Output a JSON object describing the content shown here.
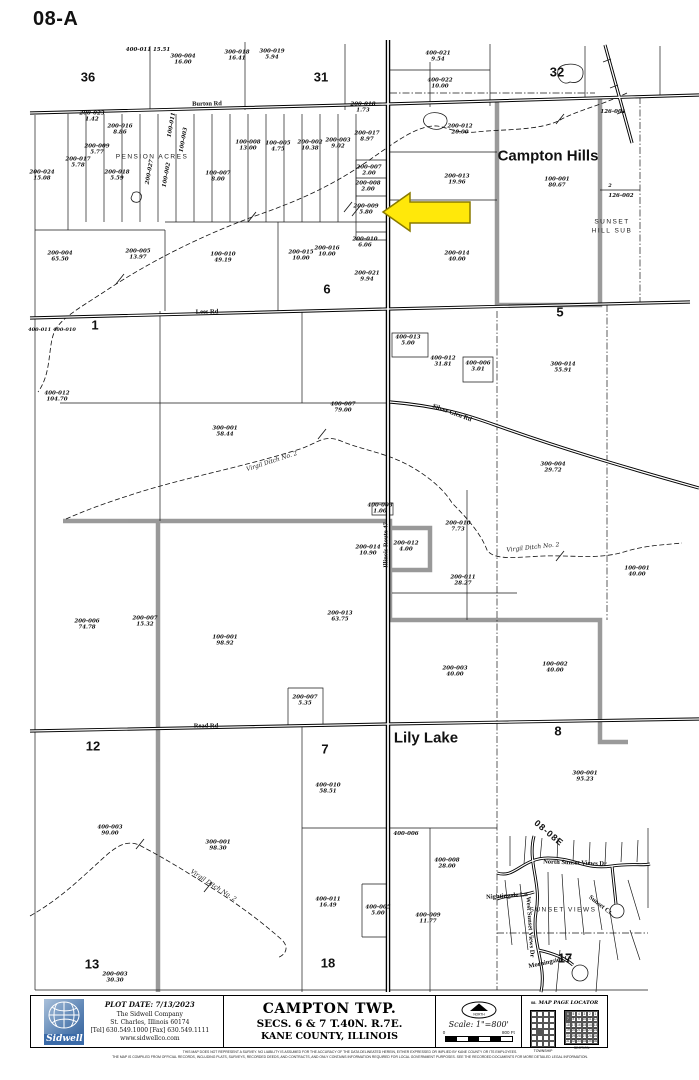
{
  "page": {
    "sheet_label": "08-A"
  },
  "map": {
    "arrow": {
      "target_parcel": "200-009",
      "color": "#ffe80a",
      "stroke": "#8a7a00"
    },
    "labels": [
      {
        "t": "Campton Hills",
        "x": 548,
        "y": 156,
        "cls": "muni",
        "name": "municipality-label-campton-hills"
      },
      {
        "t": "Lily Lake",
        "x": 426,
        "y": 738,
        "cls": "muni",
        "name": "municipality-label-lily-lake"
      },
      {
        "t": "36",
        "x": 88,
        "y": 77,
        "cls": "section",
        "name": "section-number-36"
      },
      {
        "t": "31",
        "x": 321,
        "y": 77,
        "cls": "section",
        "name": "section-number-31"
      },
      {
        "t": "32",
        "x": 557,
        "y": 72,
        "cls": "section",
        "name": "section-number-32"
      },
      {
        "t": "1",
        "x": 95,
        "y": 325,
        "cls": "section",
        "name": "section-number-1"
      },
      {
        "t": "6",
        "x": 327,
        "y": 289,
        "cls": "section",
        "name": "section-number-6"
      },
      {
        "t": "5",
        "x": 560,
        "y": 312,
        "cls": "section",
        "name": "section-number-5"
      },
      {
        "t": "12",
        "x": 93,
        "y": 746,
        "cls": "section",
        "name": "section-number-12"
      },
      {
        "t": "7",
        "x": 325,
        "y": 749,
        "cls": "section",
        "name": "section-number-7"
      },
      {
        "t": "8",
        "x": 558,
        "y": 731,
        "cls": "section",
        "name": "section-number-8"
      },
      {
        "t": "13",
        "x": 92,
        "y": 964,
        "cls": "section",
        "name": "section-number-13"
      },
      {
        "t": "18",
        "x": 328,
        "y": 963,
        "cls": "section",
        "name": "section-number-18"
      },
      {
        "t": "17",
        "x": 565,
        "y": 958,
        "cls": "section",
        "name": "section-number-17"
      },
      {
        "t": "Burton Rd",
        "x": 207,
        "y": 104,
        "r": -1,
        "cls": "road",
        "name": "road-label-burton-rd"
      },
      {
        "t": "Lees Rd",
        "x": 207,
        "y": 312,
        "r": -1,
        "cls": "road",
        "name": "road-label-lees-rd"
      },
      {
        "t": "Read Rd",
        "x": 206,
        "y": 726,
        "cls": "road",
        "name": "road-label-read-rd"
      },
      {
        "t": "Illinois Route 47",
        "x": 386,
        "y": 545,
        "r": -90,
        "cls": "road",
        "name": "road-label-illinois-route-47"
      },
      {
        "t": "Silver Glen Rd",
        "x": 452,
        "y": 413,
        "r": 20,
        "cls": "road",
        "name": "road-label-silver-glen-rd"
      },
      {
        "t": "North Sunset Views Dr",
        "x": 575,
        "y": 863,
        "r": 2,
        "cls": "road",
        "name": "road-label-north-sunset-views-dr"
      },
      {
        "t": "Nightingale Ln",
        "x": 507,
        "y": 896,
        "r": -4,
        "cls": "road",
        "name": "road-label-nightingale-ln"
      },
      {
        "t": "West Sunset Views Dr",
        "x": 530,
        "y": 927,
        "r": 86,
        "cls": "road",
        "name": "road-label-west-sunset-views-dr"
      },
      {
        "t": "Sunset Ct",
        "x": 600,
        "y": 905,
        "r": 38,
        "cls": "road",
        "name": "road-label-sunset-ct"
      },
      {
        "t": "Morningside Ct",
        "x": 550,
        "y": 962,
        "r": -12,
        "cls": "road",
        "name": "road-label-morningside-ct"
      },
      {
        "t": "PENSION ACRES",
        "x": 152,
        "y": 157,
        "cls": "subdiv",
        "name": "subdivision-label-pension-acres"
      },
      {
        "t": "SUNSET VIEWS",
        "x": 563,
        "y": 910,
        "cls": "subdiv",
        "name": "subdivision-label-sunset-views"
      },
      {
        "t": "SUNSET",
        "x": 612,
        "y": 222,
        "cls": "subdiv",
        "name": "subdivision-label-sunset-hill-sub"
      },
      {
        "t": "HILL SUB",
        "x": 612,
        "y": 231,
        "cls": "subdiv",
        "name": "subdivision-label-sunset-hill-sub-2"
      },
      {
        "t": "Virgil Ditch No. 2",
        "x": 272,
        "y": 462,
        "r": -18,
        "cls": "creek",
        "name": "creek-label-virgil-ditch-1"
      },
      {
        "t": "Virgil Ditch No. 2",
        "x": 533,
        "y": 548,
        "r": -6,
        "cls": "creek",
        "name": "creek-label-virgil-ditch-2"
      },
      {
        "t": "Virgil Ditch No. 2",
        "x": 213,
        "y": 886,
        "r": 33,
        "cls": "creek",
        "name": "creek-label-virgil-ditch-3"
      },
      {
        "t": "08-08E",
        "x": 549,
        "y": 833,
        "r": 40,
        "cls": "pageref",
        "name": "adjacent-page-label"
      },
      {
        "t": "400-011 400-010",
        "x": 52,
        "y": 330,
        "cls": "misc",
        "name": "parcel-pair-label"
      },
      {
        "t": "2",
        "x": 610,
        "y": 186,
        "cls": "misc",
        "name": "lot-number-2"
      }
    ],
    "parcels": [
      {
        "id": "400-011",
        "ac": "15.51",
        "x": 148,
        "y": 50,
        "one": true
      },
      {
        "id": "300-004",
        "ac": "16.00",
        "x": 183,
        "y": 60
      },
      {
        "id": "300-018",
        "ac": "16.41",
        "x": 237,
        "y": 56
      },
      {
        "id": "300-019",
        "ac": "5.94",
        "x": 272,
        "y": 55
      },
      {
        "id": "400-021",
        "ac": "9.54",
        "x": 438,
        "y": 57
      },
      {
        "id": "400-022",
        "ac": "10.00",
        "x": 440,
        "y": 84
      },
      {
        "id": "200-012",
        "ac": "20.00",
        "x": 460,
        "y": 130
      },
      {
        "id": "126-001",
        "ac": "",
        "x": 613,
        "y": 112
      },
      {
        "id": "126-002",
        "ac": "",
        "x": 621,
        "y": 196
      },
      {
        "id": "100-001",
        "ac": "80.67",
        "x": 557,
        "y": 183
      },
      {
        "id": "200-013",
        "ac": "19.96",
        "x": 457,
        "y": 180
      },
      {
        "id": "200-014",
        "ac": "40.00",
        "x": 457,
        "y": 257
      },
      {
        "id": "200-007",
        "ac": "2.00",
        "x": 369,
        "y": 171
      },
      {
        "id": "200-008",
        "ac": "2.00",
        "x": 368,
        "y": 187
      },
      {
        "id": "200-009",
        "ac": "5.80",
        "x": 366,
        "y": 210
      },
      {
        "id": "200-010",
        "ac": "6.06",
        "x": 365,
        "y": 243
      },
      {
        "id": "200-015",
        "ac": "10.00",
        "x": 301,
        "y": 256
      },
      {
        "id": "200-016",
        "ac": "10.00",
        "x": 327,
        "y": 252
      },
      {
        "id": "200-021",
        "ac": "9.94",
        "x": 367,
        "y": 277
      },
      {
        "id": "200-004",
        "ac": "65.50",
        "x": 60,
        "y": 257
      },
      {
        "id": "200-005",
        "ac": "13.97",
        "x": 138,
        "y": 255
      },
      {
        "id": "100-010",
        "ac": "49.19",
        "x": 223,
        "y": 258
      },
      {
        "id": "200-024",
        "ac": "15.08",
        "x": 42,
        "y": 176
      },
      {
        "id": "200-017",
        "ac": "5.78",
        "x": 78,
        "y": 163
      },
      {
        "id": "200-009",
        "ac": "5.77",
        "x": 97,
        "y": 150
      },
      {
        "id": "200-023",
        "ac": "1.42",
        "x": 92,
        "y": 117
      },
      {
        "id": "200-016",
        "ac": "8.86",
        "x": 120,
        "y": 130
      },
      {
        "id": "200-018",
        "ac": "5.59",
        "x": 117,
        "y": 176
      },
      {
        "id": "100-008",
        "ac": "13.00",
        "x": 248,
        "y": 146
      },
      {
        "id": "100-005",
        "ac": "4.75",
        "x": 278,
        "y": 147
      },
      {
        "id": "200-002",
        "ac": "10.38",
        "x": 310,
        "y": 146
      },
      {
        "id": "200-003",
        "ac": "9.02",
        "x": 338,
        "y": 144
      },
      {
        "id": "200-018",
        "ac": "1.73",
        "x": 363,
        "y": 108
      },
      {
        "id": "200-017",
        "ac": "8.97",
        "x": 367,
        "y": 137
      },
      {
        "id": "100-007",
        "ac": "8.00",
        "x": 218,
        "y": 177
      },
      {
        "id": "200-027",
        "ac": "",
        "x": 150,
        "y": 172,
        "r": -80
      },
      {
        "id": "100-011",
        "ac": "",
        "x": 172,
        "y": 125,
        "r": -80
      },
      {
        "id": "100-003",
        "ac": "",
        "x": 184,
        "y": 140,
        "r": -80
      },
      {
        "id": "100-002",
        "ac": "",
        "x": 167,
        "y": 175,
        "r": -80
      },
      {
        "id": "400-013",
        "ac": "5.00",
        "x": 408,
        "y": 341
      },
      {
        "id": "400-012",
        "ac": "31.81",
        "x": 443,
        "y": 362
      },
      {
        "id": "400-006",
        "ac": "3.01",
        "x": 478,
        "y": 367
      },
      {
        "id": "300-014",
        "ac": "55.91",
        "x": 563,
        "y": 368
      },
      {
        "id": "400-012",
        "ac": "104.70",
        "x": 57,
        "y": 397
      },
      {
        "id": "300-001",
        "ac": "58.44",
        "x": 225,
        "y": 432
      },
      {
        "id": "400-007",
        "ac": "79.00",
        "x": 343,
        "y": 408
      },
      {
        "id": "300-004",
        "ac": "29.72",
        "x": 553,
        "y": 468
      },
      {
        "id": "400-008",
        "ac": "1.00",
        "x": 380,
        "y": 509
      },
      {
        "id": "200-014",
        "ac": "10.90",
        "x": 368,
        "y": 551
      },
      {
        "id": "200-012",
        "ac": "4.00",
        "x": 406,
        "y": 547
      },
      {
        "id": "200-010",
        "ac": "7.73",
        "x": 458,
        "y": 527
      },
      {
        "id": "200-011",
        "ac": "28.27",
        "x": 463,
        "y": 581
      },
      {
        "id": "100-001",
        "ac": "40.00",
        "x": 637,
        "y": 572
      },
      {
        "id": "200-006",
        "ac": "74.78",
        "x": 87,
        "y": 625
      },
      {
        "id": "200-007",
        "ac": "15.32",
        "x": 145,
        "y": 622
      },
      {
        "id": "100-001",
        "ac": "98.92",
        "x": 225,
        "y": 641
      },
      {
        "id": "200-013",
        "ac": "63.75",
        "x": 340,
        "y": 617
      },
      {
        "id": "200-007",
        "ac": "5.35",
        "x": 305,
        "y": 701
      },
      {
        "id": "200-003",
        "ac": "40.00",
        "x": 455,
        "y": 672
      },
      {
        "id": "100-002",
        "ac": "40.00",
        "x": 555,
        "y": 668
      },
      {
        "id": "300-001",
        "ac": "95.23",
        "x": 585,
        "y": 777
      },
      {
        "id": "400-010",
        "ac": "58.51",
        "x": 328,
        "y": 789
      },
      {
        "id": "400-003",
        "ac": "90.00",
        "x": 110,
        "y": 831
      },
      {
        "id": "300-001",
        "ac": "98.30",
        "x": 218,
        "y": 846
      },
      {
        "id": "400-006",
        "ac": "",
        "x": 406,
        "y": 834
      },
      {
        "id": "400-008",
        "ac": "28.00",
        "x": 447,
        "y": 864
      },
      {
        "id": "400-011",
        "ac": "16.49",
        "x": 328,
        "y": 903
      },
      {
        "id": "400-005",
        "ac": "5.00",
        "x": 378,
        "y": 911
      },
      {
        "id": "400-009",
        "ac": "11.77",
        "x": 428,
        "y": 919
      },
      {
        "id": "200-003",
        "ac": "30.30",
        "x": 115,
        "y": 978
      }
    ]
  },
  "footer": {
    "logo_text": "Sidwell",
    "plot_date": "PLOT DATE: 7/13/2023",
    "company": "The Sidwell Company",
    "address": "St. Charles, Illinois 60174",
    "phones": "[Tel] 630.549.1000 [Fax] 630.549.1111",
    "website": "www.sidwellco.com",
    "township_title": "CAMPTON TWP.",
    "township_sub1": "SECS. 6 & 7 T.40N. R.7E.",
    "township_sub2": "KANE COUNTY, ILLINOIS",
    "north_label": "NORTH",
    "scale_text": "Scale: 1\"=800'",
    "scale_zero": "0",
    "scale_end": "800 Ft",
    "locator": {
      "book": "08.",
      "title": "MAP PAGE LOCATOR",
      "township_caption": "TOWNSHIP",
      "section_caption": "SECTION",
      "township_rows": 6,
      "township_cols": 4,
      "township_highlight": {
        "row": 3,
        "col": 1
      },
      "section_grid": [
        [
          6,
          5,
          4,
          3,
          2,
          1
        ],
        [
          7,
          8,
          9,
          10,
          11,
          12
        ],
        [
          18,
          17,
          16,
          15,
          14,
          13
        ],
        [
          19,
          20,
          21,
          22,
          23,
          24
        ],
        [
          30,
          29,
          28,
          27,
          26,
          25
        ],
        [
          31,
          32,
          33,
          34,
          35,
          36
        ]
      ],
      "section_highlights": [
        6,
        7
      ]
    },
    "disclaimer1": "THIS MAP DOES NOT REPRESENT A SURVEY. NO LIABILITY IS ASSUMED FOR THE ACCURACY OF THE DATA DELINEATED HEREIN, EITHER EXPRESSED OR IMPLIED BY KANE COUNTY OR ITS EMPLOYEES.",
    "disclaimer2": "THE MAP IS COMPILED FROM OFFICIAL RECORDS, INCLUDING PLATS, SURVEYS, RECORDED DEEDS, AND CONTRACTS, AND ONLY CONTAINS INFORMATION REQUIRED FOR LOCAL GOVERNMENT PURPOSES. SEE THE RECORDED DOCUMENTS FOR MORE DETAILED LEGAL INFORMATION."
  }
}
